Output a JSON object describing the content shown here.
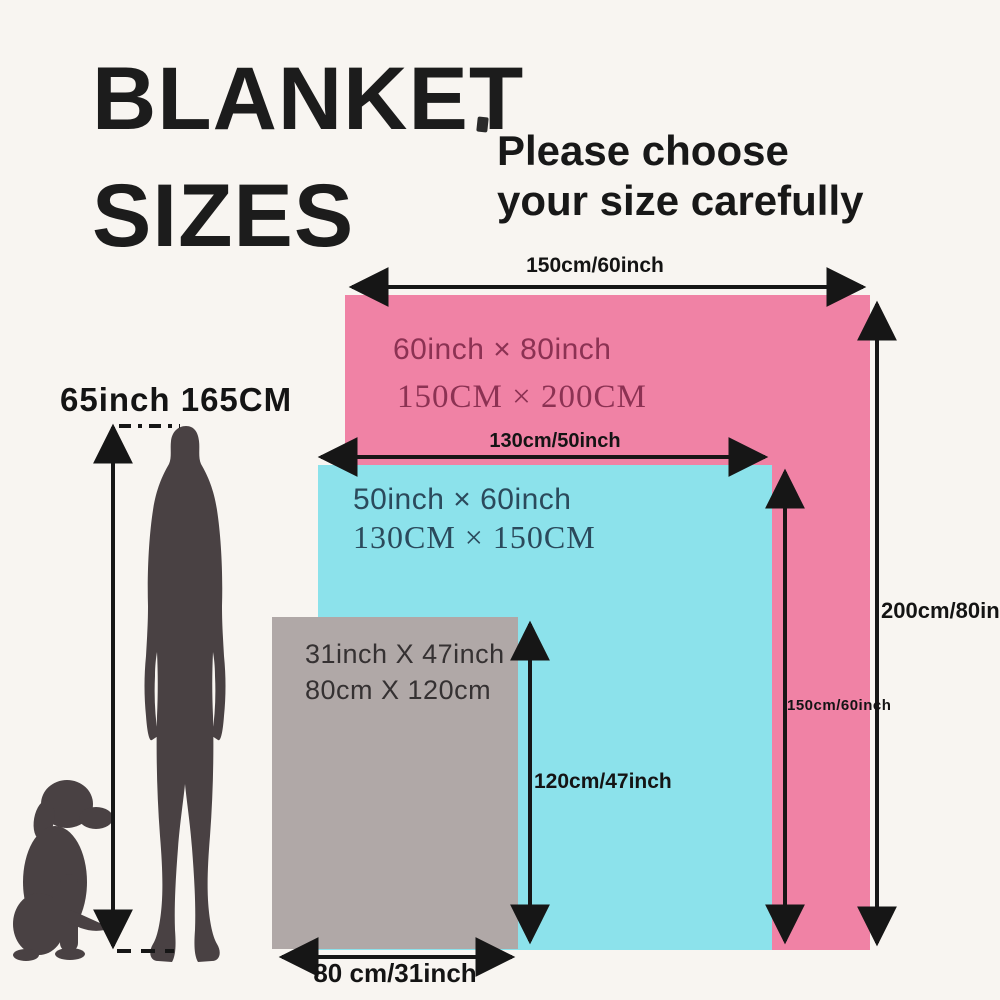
{
  "meta": {
    "background_color": "#f8f5f1",
    "ink_color": "#161616",
    "silhouette_color": "#494143"
  },
  "title": {
    "line1": "BLANKET",
    "line2": "SIZES"
  },
  "subtitle": {
    "line1": "Please choose",
    "line2": "your size carefully"
  },
  "person": {
    "height_label": "65inch 165CM"
  },
  "blankets": {
    "large": {
      "color": "#f082a5",
      "text_color": "#8c3253",
      "size_inch": "60inch × 80inch",
      "size_cm": "150CM × 200CM",
      "width_label": "150cm/60inch",
      "height_label": "200cm/80inch"
    },
    "medium": {
      "color": "#8ce2eb",
      "text_color": "#2b4a5c",
      "size_inch": "50inch × 60inch",
      "size_cm": "130CM × 150CM",
      "width_label": "130cm/50inch",
      "height_label": "150cm/60inch"
    },
    "small": {
      "color": "#b0a8a7",
      "text_color": "#353132",
      "size_inch": "31inch X 47inch",
      "size_cm": "80cm X 120cm",
      "width_label": "80 cm/31inch",
      "height_label": "120cm/47inch"
    }
  }
}
